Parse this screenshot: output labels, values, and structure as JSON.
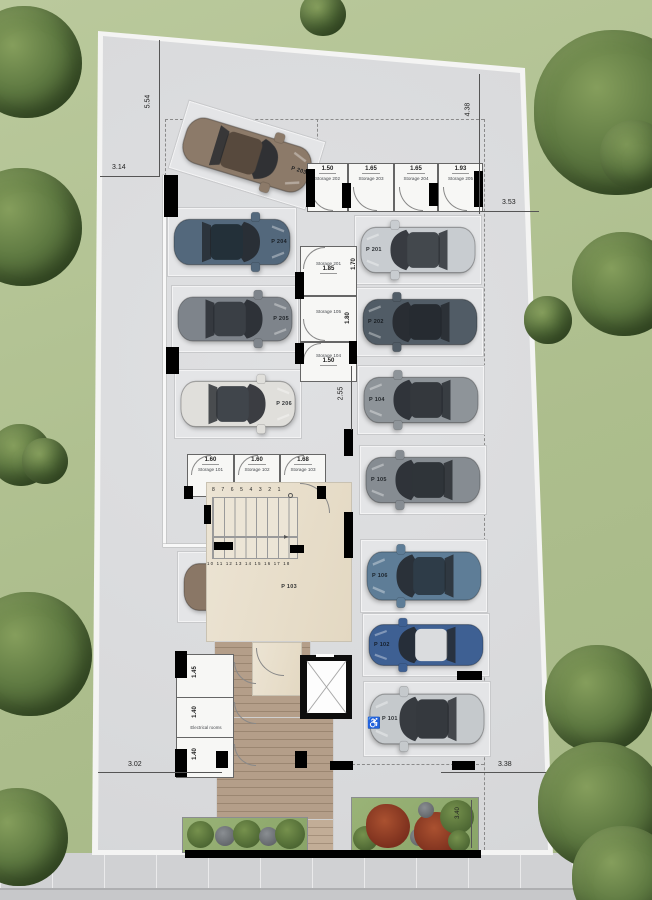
{
  "plan": {
    "name": "parking-level-floor-plan",
    "stair_numbers_upper": "8 7 6 5 4 3 2 1",
    "stair_numbers_lower": "10 11 12 13 14 15 16 17 18",
    "stair_arrow": "▸"
  },
  "storages": {
    "top_row": [
      {
        "label": "Storage 202",
        "width": "1.50"
      },
      {
        "label": "Storage 203",
        "width": "1.65"
      },
      {
        "label": "Storage 204",
        "width": "1.65"
      },
      {
        "label": "Storage 205",
        "width": "1.93"
      }
    ],
    "mid_column": [
      {
        "label": "Storage 201",
        "width": "1.85",
        "height": "1.70"
      },
      {
        "label": "Storage 105",
        "height": "1.80"
      },
      {
        "label": "Storage 104",
        "width": "1.50",
        "height": "1.80"
      }
    ],
    "mid_row": [
      {
        "label": "Storage 101",
        "width": "1.60"
      },
      {
        "label": "Storage 102",
        "width": "1.60"
      },
      {
        "label": "Storage 103",
        "width": "1.68"
      }
    ],
    "electrical": {
      "label": "Electrical rooms",
      "heights": [
        "1.45",
        "1.40",
        "1.40"
      ]
    }
  },
  "parking": {
    "left": [
      {
        "label": "P 203",
        "body": "#8c7a69",
        "roof": "#57493d"
      },
      {
        "label": "P 204",
        "body": "#53687c",
        "roof": "#233039"
      },
      {
        "label": "P 205",
        "body": "#7e848b",
        "roof": "#3a3f45"
      },
      {
        "label": "P 206",
        "body": "#e0dfdb",
        "roof": "#40454b"
      },
      {
        "label": "P 103",
        "body": "#8a7766",
        "roof": "#453d33"
      }
    ],
    "right": [
      {
        "label": "P 201",
        "body": "#c8ccd0",
        "roof": "#43484d"
      },
      {
        "label": "P 202",
        "body": "#515c66",
        "roof": "#262b31"
      },
      {
        "label": "P 104",
        "body": "#8e9499",
        "roof": "#34383d"
      },
      {
        "label": "P 105",
        "body": "#868c92",
        "roof": "#2f3439"
      },
      {
        "label": "P 106",
        "body": "#5e7d97",
        "roof": "#2e3c48"
      },
      {
        "label": "P 102",
        "body": "#3e6093",
        "roof": "#dadcde"
      },
      {
        "label": "P 101",
        "body": "#c5c9cc",
        "roof": "#35393e"
      }
    ],
    "accessible_icon": "♿"
  },
  "dimensions": {
    "top_left_vertical": "5.54",
    "top_left_horizontal": "3.14",
    "top_right_vertical": "4.38",
    "right_horizontal": "3.53",
    "aisle_vertical": "2.55",
    "bottom_left_horizontal": "3.02",
    "bottom_right_horizontal": "3.38",
    "planter_vertical": "3.40"
  },
  "colors": {
    "grass": "#aebf90",
    "plot": "#dbdcde",
    "wood_deck": "#b49e89",
    "lobby_marble": "#eae1d1",
    "planter_green": "#92ad72",
    "tree_green": "#4f6936",
    "wall_black": "#000000"
  }
}
